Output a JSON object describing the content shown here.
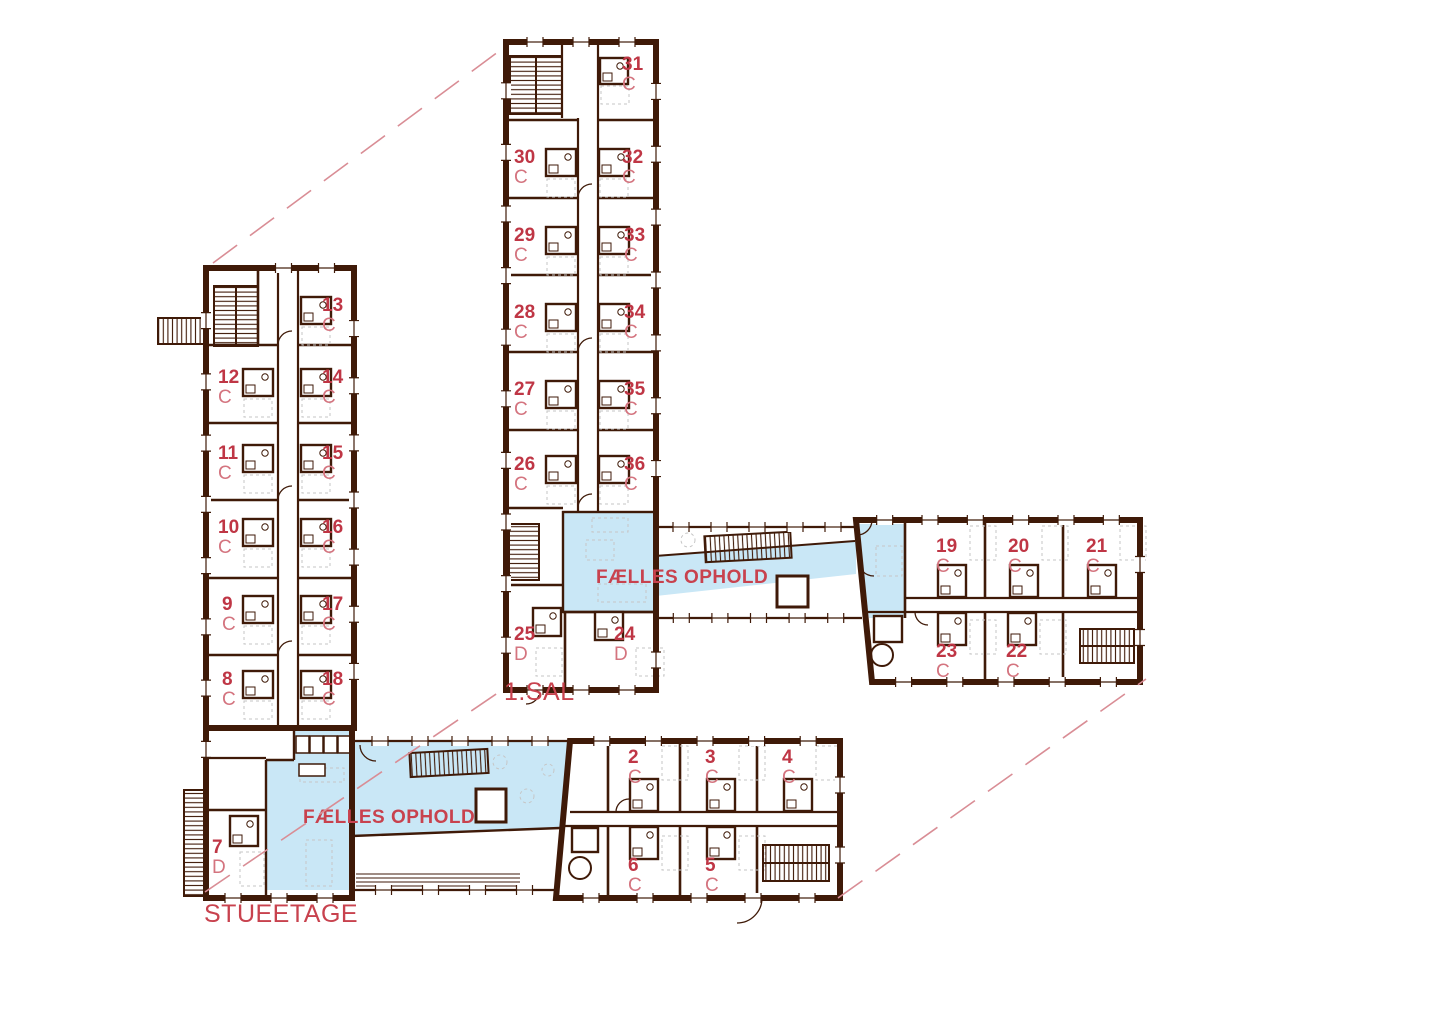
{
  "labels": {
    "floor_upper": "1.SAL",
    "floor_ground": "STUEETAGE",
    "common_upper": "FÆLLES OPHOLD",
    "common_ground": "FÆLLES OPHOLD"
  },
  "rooms": [
    {
      "num": "31",
      "letter": "C",
      "floor": "1.SAL",
      "x": 622,
      "y": 70
    },
    {
      "num": "30",
      "letter": "C",
      "floor": "1.SAL",
      "x": 514,
      "y": 163
    },
    {
      "num": "32",
      "letter": "C",
      "floor": "1.SAL",
      "x": 622,
      "y": 163
    },
    {
      "num": "29",
      "letter": "C",
      "floor": "1.SAL",
      "x": 514,
      "y": 241
    },
    {
      "num": "33",
      "letter": "C",
      "floor": "1.SAL",
      "x": 624,
      "y": 241
    },
    {
      "num": "28",
      "letter": "C",
      "floor": "1.SAL",
      "x": 514,
      "y": 318
    },
    {
      "num": "34",
      "letter": "C",
      "floor": "1.SAL",
      "x": 624,
      "y": 318
    },
    {
      "num": "27",
      "letter": "C",
      "floor": "1.SAL",
      "x": 514,
      "y": 395
    },
    {
      "num": "35",
      "letter": "C",
      "floor": "1.SAL",
      "x": 624,
      "y": 395
    },
    {
      "num": "26",
      "letter": "C",
      "floor": "1.SAL",
      "x": 514,
      "y": 470
    },
    {
      "num": "36",
      "letter": "C",
      "floor": "1.SAL",
      "x": 624,
      "y": 470
    },
    {
      "num": "25",
      "letter": "D",
      "floor": "1.SAL",
      "x": 514,
      "y": 640
    },
    {
      "num": "24",
      "letter": "D",
      "floor": "1.SAL",
      "x": 614,
      "y": 640
    },
    {
      "num": "19",
      "letter": "C",
      "floor": "1.SAL",
      "x": 936,
      "y": 552
    },
    {
      "num": "20",
      "letter": "C",
      "floor": "1.SAL",
      "x": 1008,
      "y": 552
    },
    {
      "num": "21",
      "letter": "C",
      "floor": "1.SAL",
      "x": 1086,
      "y": 552
    },
    {
      "num": "23",
      "letter": "C",
      "floor": "1.SAL",
      "x": 936,
      "y": 657
    },
    {
      "num": "22",
      "letter": "C",
      "floor": "1.SAL",
      "x": 1006,
      "y": 657
    },
    {
      "num": "13",
      "letter": "C",
      "floor": "STUEETAGE",
      "x": 322,
      "y": 311
    },
    {
      "num": "12",
      "letter": "C",
      "floor": "STUEETAGE",
      "x": 218,
      "y": 383
    },
    {
      "num": "14",
      "letter": "C",
      "floor": "STUEETAGE",
      "x": 322,
      "y": 383
    },
    {
      "num": "11",
      "letter": "C",
      "floor": "STUEETAGE",
      "x": 218,
      "y": 459
    },
    {
      "num": "15",
      "letter": "C",
      "floor": "STUEETAGE",
      "x": 322,
      "y": 459
    },
    {
      "num": "10",
      "letter": "C",
      "floor": "STUEETAGE",
      "x": 218,
      "y": 533
    },
    {
      "num": "16",
      "letter": "C",
      "floor": "STUEETAGE",
      "x": 322,
      "y": 533
    },
    {
      "num": "9",
      "letter": "C",
      "floor": "STUEETAGE",
      "x": 222,
      "y": 610
    },
    {
      "num": "17",
      "letter": "C",
      "floor": "STUEETAGE",
      "x": 322,
      "y": 610
    },
    {
      "num": "8",
      "letter": "C",
      "floor": "STUEETAGE",
      "x": 222,
      "y": 685
    },
    {
      "num": "18",
      "letter": "C",
      "floor": "STUEETAGE",
      "x": 322,
      "y": 685
    },
    {
      "num": "7",
      "letter": "D",
      "floor": "STUEETAGE",
      "x": 212,
      "y": 853
    },
    {
      "num": "2",
      "letter": "C",
      "floor": "STUEETAGE",
      "x": 628,
      "y": 763
    },
    {
      "num": "3",
      "letter": "C",
      "floor": "STUEETAGE",
      "x": 705,
      "y": 763
    },
    {
      "num": "4",
      "letter": "C",
      "floor": "STUEETAGE",
      "x": 782,
      "y": 763
    },
    {
      "num": "6",
      "letter": "C",
      "floor": "STUEETAGE",
      "x": 628,
      "y": 871
    },
    {
      "num": "5",
      "letter": "C",
      "floor": "STUEETAGE",
      "x": 705,
      "y": 871
    }
  ],
  "colors": {
    "wall": "#3f1a08",
    "room_number": "#bf3645",
    "room_letter": "#d4747f",
    "label": "#c8424e",
    "common_fill": "#c9e7f6",
    "dash_line": "#d98d95",
    "furniture": "#c6c6c6"
  }
}
